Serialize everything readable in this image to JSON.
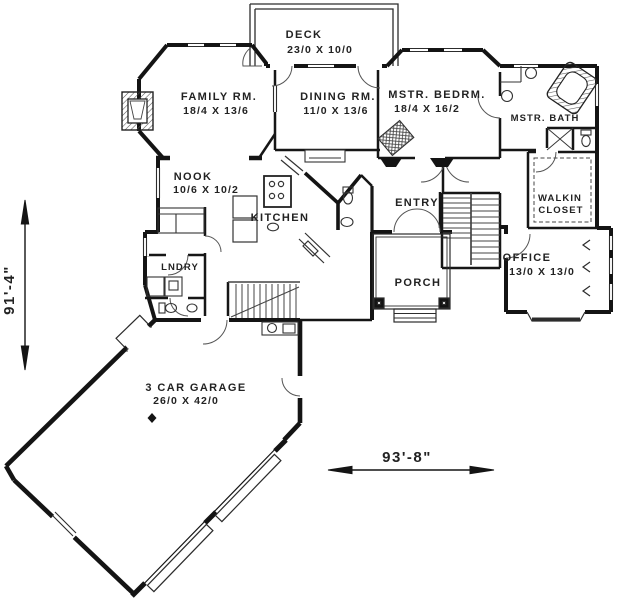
{
  "plan": {
    "type": "house-first-floor-plan",
    "rooms": {
      "deck": {
        "name": "DECK",
        "dims": "23/0 X 10/0"
      },
      "family_room": {
        "name": "FAMILY RM.",
        "dims": "18/4 X 13/6"
      },
      "dining_room": {
        "name": "DINING RM.",
        "dims": "11/0 X 13/6"
      },
      "master_bedroom": {
        "name": "MSTR. BEDRM.",
        "dims": "18/4 X 16/2"
      },
      "master_bath": {
        "name": "MSTR. BATH"
      },
      "walkin_closet": {
        "line1": "WALKIN",
        "line2": "CLOSET"
      },
      "nook": {
        "name": "NOOK",
        "dims": "10/6 X 10/2"
      },
      "kitchen": {
        "name": "KITCHEN"
      },
      "entry": {
        "name": "ENTRY"
      },
      "laundry": {
        "name": "LNDRY"
      },
      "porch": {
        "name": "PORCH"
      },
      "office": {
        "name": "OFFICE",
        "dims": "13/0 X 13/0"
      },
      "garage": {
        "name": "3 CAR GARAGE",
        "dims": "26/0 X 42/0"
      }
    },
    "overall_dimensions": {
      "depth": "91'-4\"",
      "width": "93'-8\""
    },
    "colors": {
      "ink": "#1c1c1c",
      "paper": "#ffffff"
    }
  }
}
